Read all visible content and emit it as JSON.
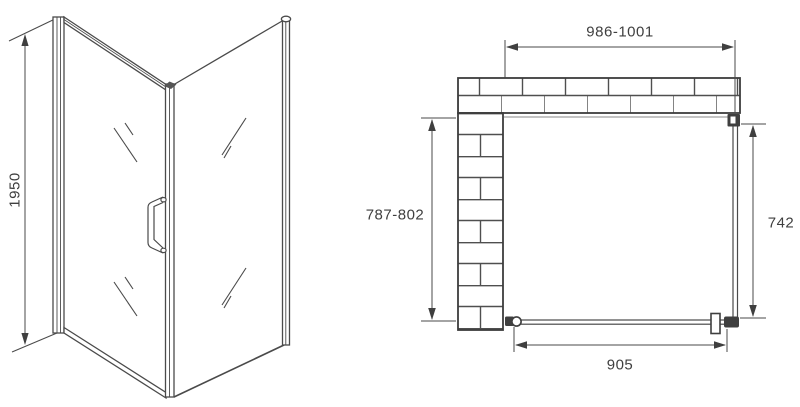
{
  "colors": {
    "line": "#4a4a4a",
    "wall_edge": "#3c3c3c",
    "text": "#3f3f3f",
    "background": "#ffffff"
  },
  "front_view": {
    "height_label": "1950"
  },
  "plan_view": {
    "width_label": "986-1001",
    "depth_label": "787-802",
    "side_panel_label": "742",
    "door_width_label": "905"
  }
}
